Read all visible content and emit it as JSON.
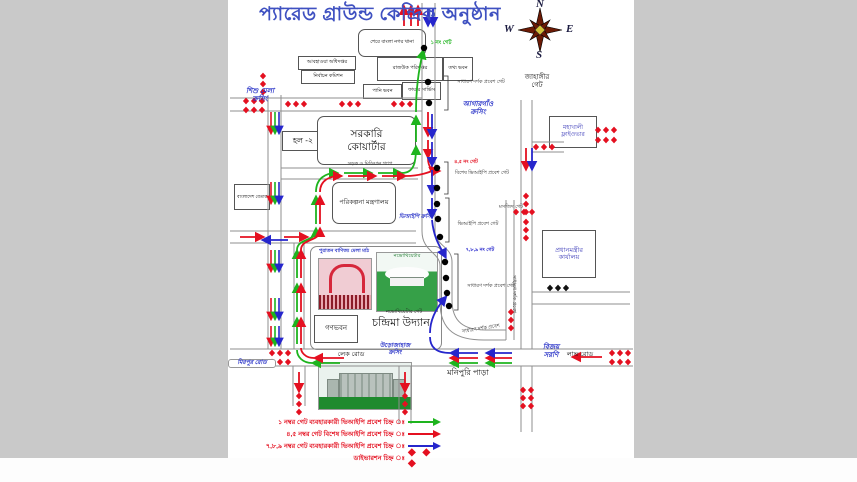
{
  "title": "প্যারেড গ্রাউন্ড কেন্দ্রিক অনুষ্ঠান",
  "compass": {
    "north": "N",
    "south": "S",
    "east": "E",
    "west": "W"
  },
  "colors": {
    "background": "#c9c9c9",
    "title_text": "#3f51c1",
    "route_green": "#1eb41e",
    "route_red": "#e41020",
    "route_blue": "#2626cc",
    "diversion_red": "#e41020",
    "crossing_text": "#2a34c8",
    "legend_text": "#e41020"
  },
  "buildings": {
    "police_box": "শেরে বাংলা নগর থানা",
    "weather": "আবহাওয়া অধিদপ্তর",
    "election": "নির্বাচন কমিশন",
    "rajuk": "রাজউক পরিদপ্তর",
    "tathya": "তথ্য ভবন",
    "pani": "পানি ভবন",
    "fire": "ফায়ার সার্ভিস",
    "betar": "বাংলাদেশ বেতার",
    "hall2": "হল -২",
    "quarter": "সরকারি\nকোয়ার্টার",
    "ministry": "পরিকল্পনা মন্ত্রণালয়",
    "pm_office": "প্রধানমন্ত্রীর\nকার্যালয়",
    "mohakhali": "মহাখালী\nফ্লাইওভার",
    "ganobhaban": "গণভবন",
    "chandrima": "চন্দ্রিমা উদ্যান",
    "old_fair_caption": "পুরাতন বাণিজ্য মেলা মাঠ",
    "novo_caption": "নভোথিয়েটার",
    "novo_gate": "নভোথিয়েটার গেট",
    "median_note": "সড়ক ও মিডিয়ান গ্যাপ"
  },
  "crossings": {
    "shishu_mela": "শিশু মেলা\nক্রসিং",
    "agargaon": "আগারগাঁও\nক্রসিং",
    "vip": "ভিআইপি ক্রসিং",
    "urojahaj": "উড়োজাহাজ\nক্রসিং"
  },
  "roads": {
    "jahangir": "জাহাঙ্গীর\nগেট",
    "bijoy": "বিজয়\nসরণি",
    "love": "লাভ রোড",
    "lake": "লেক রোড",
    "mirpur": "মিরপুর রোড",
    "monipuri": "মনিপুরি পাড়া"
  },
  "gates": {
    "no1": "১ নং গেট",
    "no45": "৪,৫ নং গেট",
    "no789": "৭,৮,৯ নং গেট",
    "general_top": "সাধারণ দর্শক প্রবেশ গেট",
    "special_vip": "বিশেষ ভিআইপি প্রবেশ গেট",
    "vip": "ভিআইপি প্রবেশ গেট",
    "general_lower": "সাধারণ দর্শক প্রবেশ গেট",
    "general_curve": "সাধারণ দর্শক প্রবেশ",
    "general_side": "সাধারণ দর্শক প্রবেশ",
    "mosque": "মসজিদ গেট"
  },
  "legend": {
    "items": [
      {
        "label": "১ নম্বর গেট ব্যবহারকারী ভিআইপি প্রবেশ চিহ্ন ঃ",
        "color": "#1eb41e",
        "symbol": "arrow"
      },
      {
        "label": "৪,৫ নম্বর গেট বিশেষ ভিআইপি প্রবেশ চিহ্ন ঃ",
        "color": "#e41020",
        "symbol": "arrow"
      },
      {
        "label": "৭,৮,৯ নম্বর গেট ব্যবহারকারী ভিআইপি প্রবেশ চিহ্ন ঃ",
        "color": "#2626cc",
        "symbol": "arrow"
      },
      {
        "label": "ডাইভারশন চিহ্ন ঃ",
        "color": "#e41020",
        "symbol": "diamonds"
      }
    ],
    "diamond_symbol": "◆ ◆ ◆"
  }
}
